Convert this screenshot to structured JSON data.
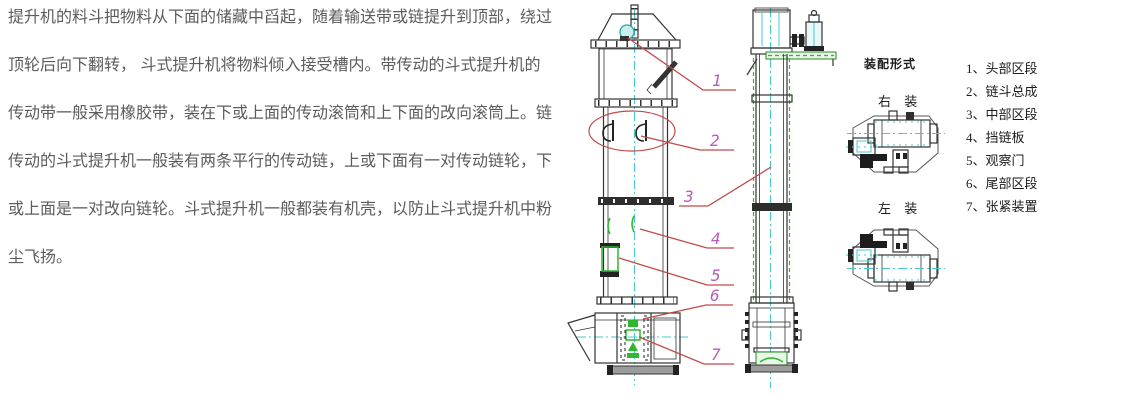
{
  "paragraph": {
    "lines": [
      "提升机的料斗把物料从下面的储藏中舀起，随着输送带或链提升到顶部，绕过",
      "顶轮后向下翻转， 斗式提升机将物料倾入接受槽内。带传动的斗式提升机的",
      "传动带一般采用橡胶带，装在下或上面的传动滚筒和上下面的改向滚筒上。链",
      "传动的斗式提升机一般装有两条平行的传动链，上或下面有一对传动链轮，下",
      "或上面是一对改向链轮。斗式提升机一般都装有机壳，以防止斗式提升机中粉",
      "尘飞扬。"
    ]
  },
  "drawing": {
    "callouts": [
      "1",
      "2",
      "3",
      "4",
      "5",
      "6",
      "7"
    ],
    "colors": {
      "leader_red": "#c04a4a",
      "callout_magenta": "#bb5abb",
      "centerline_cyan": "#49c9c9",
      "detail_green": "#2eb82e",
      "outline_black": "#333333"
    }
  },
  "assembly": {
    "title": "装配形式",
    "right_label": "右 装",
    "left_label": "左 装"
  },
  "legend": {
    "items": [
      "1、头部区段",
      "2、链斗总成",
      "3、中部区段",
      "4、挡链板",
      "5、观察门",
      "6、尾部区段",
      "7、张紧装置"
    ]
  }
}
